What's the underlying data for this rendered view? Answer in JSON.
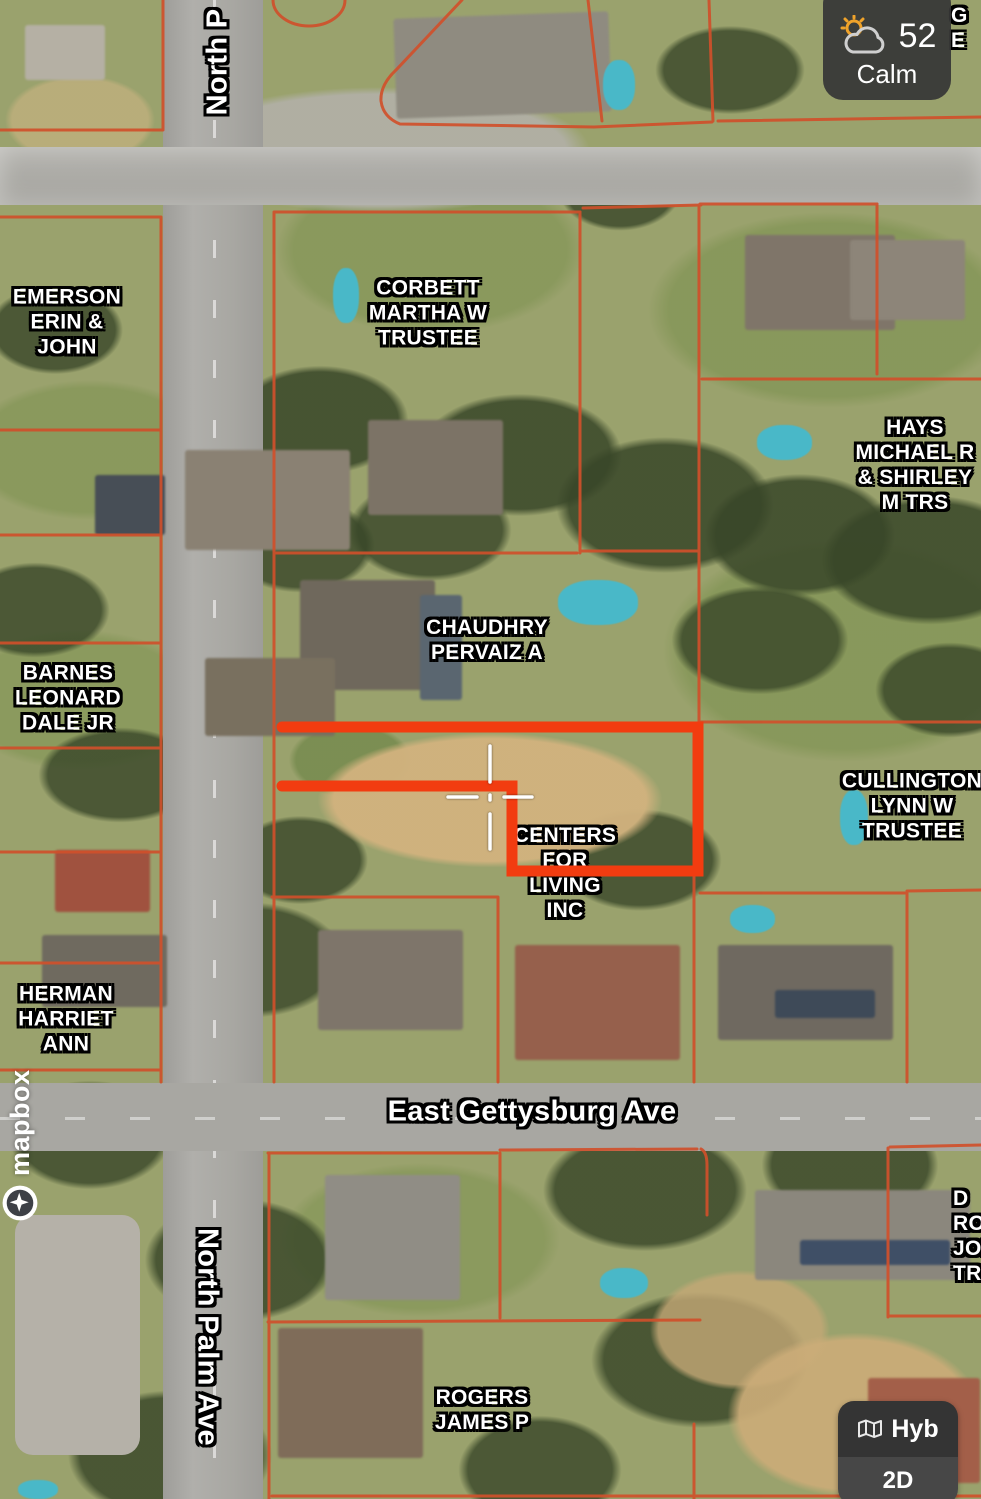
{
  "weather": {
    "temperature": "52",
    "wind": "Calm"
  },
  "map_style_control": {
    "style_label": "Hyb",
    "mode_label": "2D"
  },
  "attribution": {
    "logo_text": "mapbox"
  },
  "street_labels": [
    {
      "id": "street-label-north-palm-top",
      "text": "North P",
      "x": 218,
      "y": 62,
      "rotation": -90
    },
    {
      "id": "street-label-north-palm-bottom",
      "text": "North Palm Ave",
      "x": 207,
      "y": 1337,
      "rotation": 90
    },
    {
      "id": "street-label-east-gettysburg",
      "text": "East Gettysburg Ave",
      "x": 532,
      "y": 1112,
      "rotation": 0
    }
  ],
  "parcel_labels": [
    {
      "id": "parcel-label-emerson",
      "lines": [
        "EMERSON",
        "ERIN &",
        "JOHN"
      ],
      "x": 67,
      "y": 322
    },
    {
      "id": "parcel-label-corbett",
      "lines": [
        "CORBETT",
        "MARTHA W",
        "TRUSTEE"
      ],
      "x": 428,
      "y": 313
    },
    {
      "id": "parcel-label-hays",
      "lines": [
        "HAYS",
        "MICHAEL R",
        "& SHIRLEY",
        "M TRS"
      ],
      "x": 915,
      "y": 465
    },
    {
      "id": "parcel-label-chaudhry",
      "lines": [
        "CHAUDHRY",
        "PERVAIZ A"
      ],
      "x": 487,
      "y": 640
    },
    {
      "id": "parcel-label-barnes",
      "lines": [
        "BARNES",
        "LEONARD",
        "DALE JR"
      ],
      "x": 68,
      "y": 698
    },
    {
      "id": "parcel-label-cullington",
      "lines": [
        "CULLINGTON",
        "LYNN W",
        "TRUSTEE"
      ],
      "x": 912,
      "y": 806
    },
    {
      "id": "parcel-label-centers-for-living",
      "lines": [
        "CENTERS",
        "FOR",
        "LIVING",
        "INC"
      ],
      "x": 565,
      "y": 873
    },
    {
      "id": "parcel-label-herman",
      "lines": [
        "HERMAN",
        "HARRIET",
        "ANN"
      ],
      "x": 66,
      "y": 1019
    },
    {
      "id": "parcel-label-rogers",
      "lines": [
        "ROGERS",
        "JAMES P"
      ],
      "x": 482,
      "y": 1410
    }
  ],
  "edge_labels": [
    {
      "id": "edge-label-top-right",
      "lines": [
        "G",
        "E"
      ],
      "x": 951,
      "y": 3
    },
    {
      "id": "edge-label-bottom-right",
      "lines": [
        "D",
        "RO",
        "JOH",
        "TR"
      ],
      "x": 953,
      "y": 1186
    }
  ],
  "colors": {
    "parcel_line": "#d0502b",
    "highlight": "#f23c10",
    "road": "#a8a7a2",
    "label_fill": "#ffffff",
    "label_outline": "#000000",
    "widget_bg": "#3a3a3a"
  }
}
